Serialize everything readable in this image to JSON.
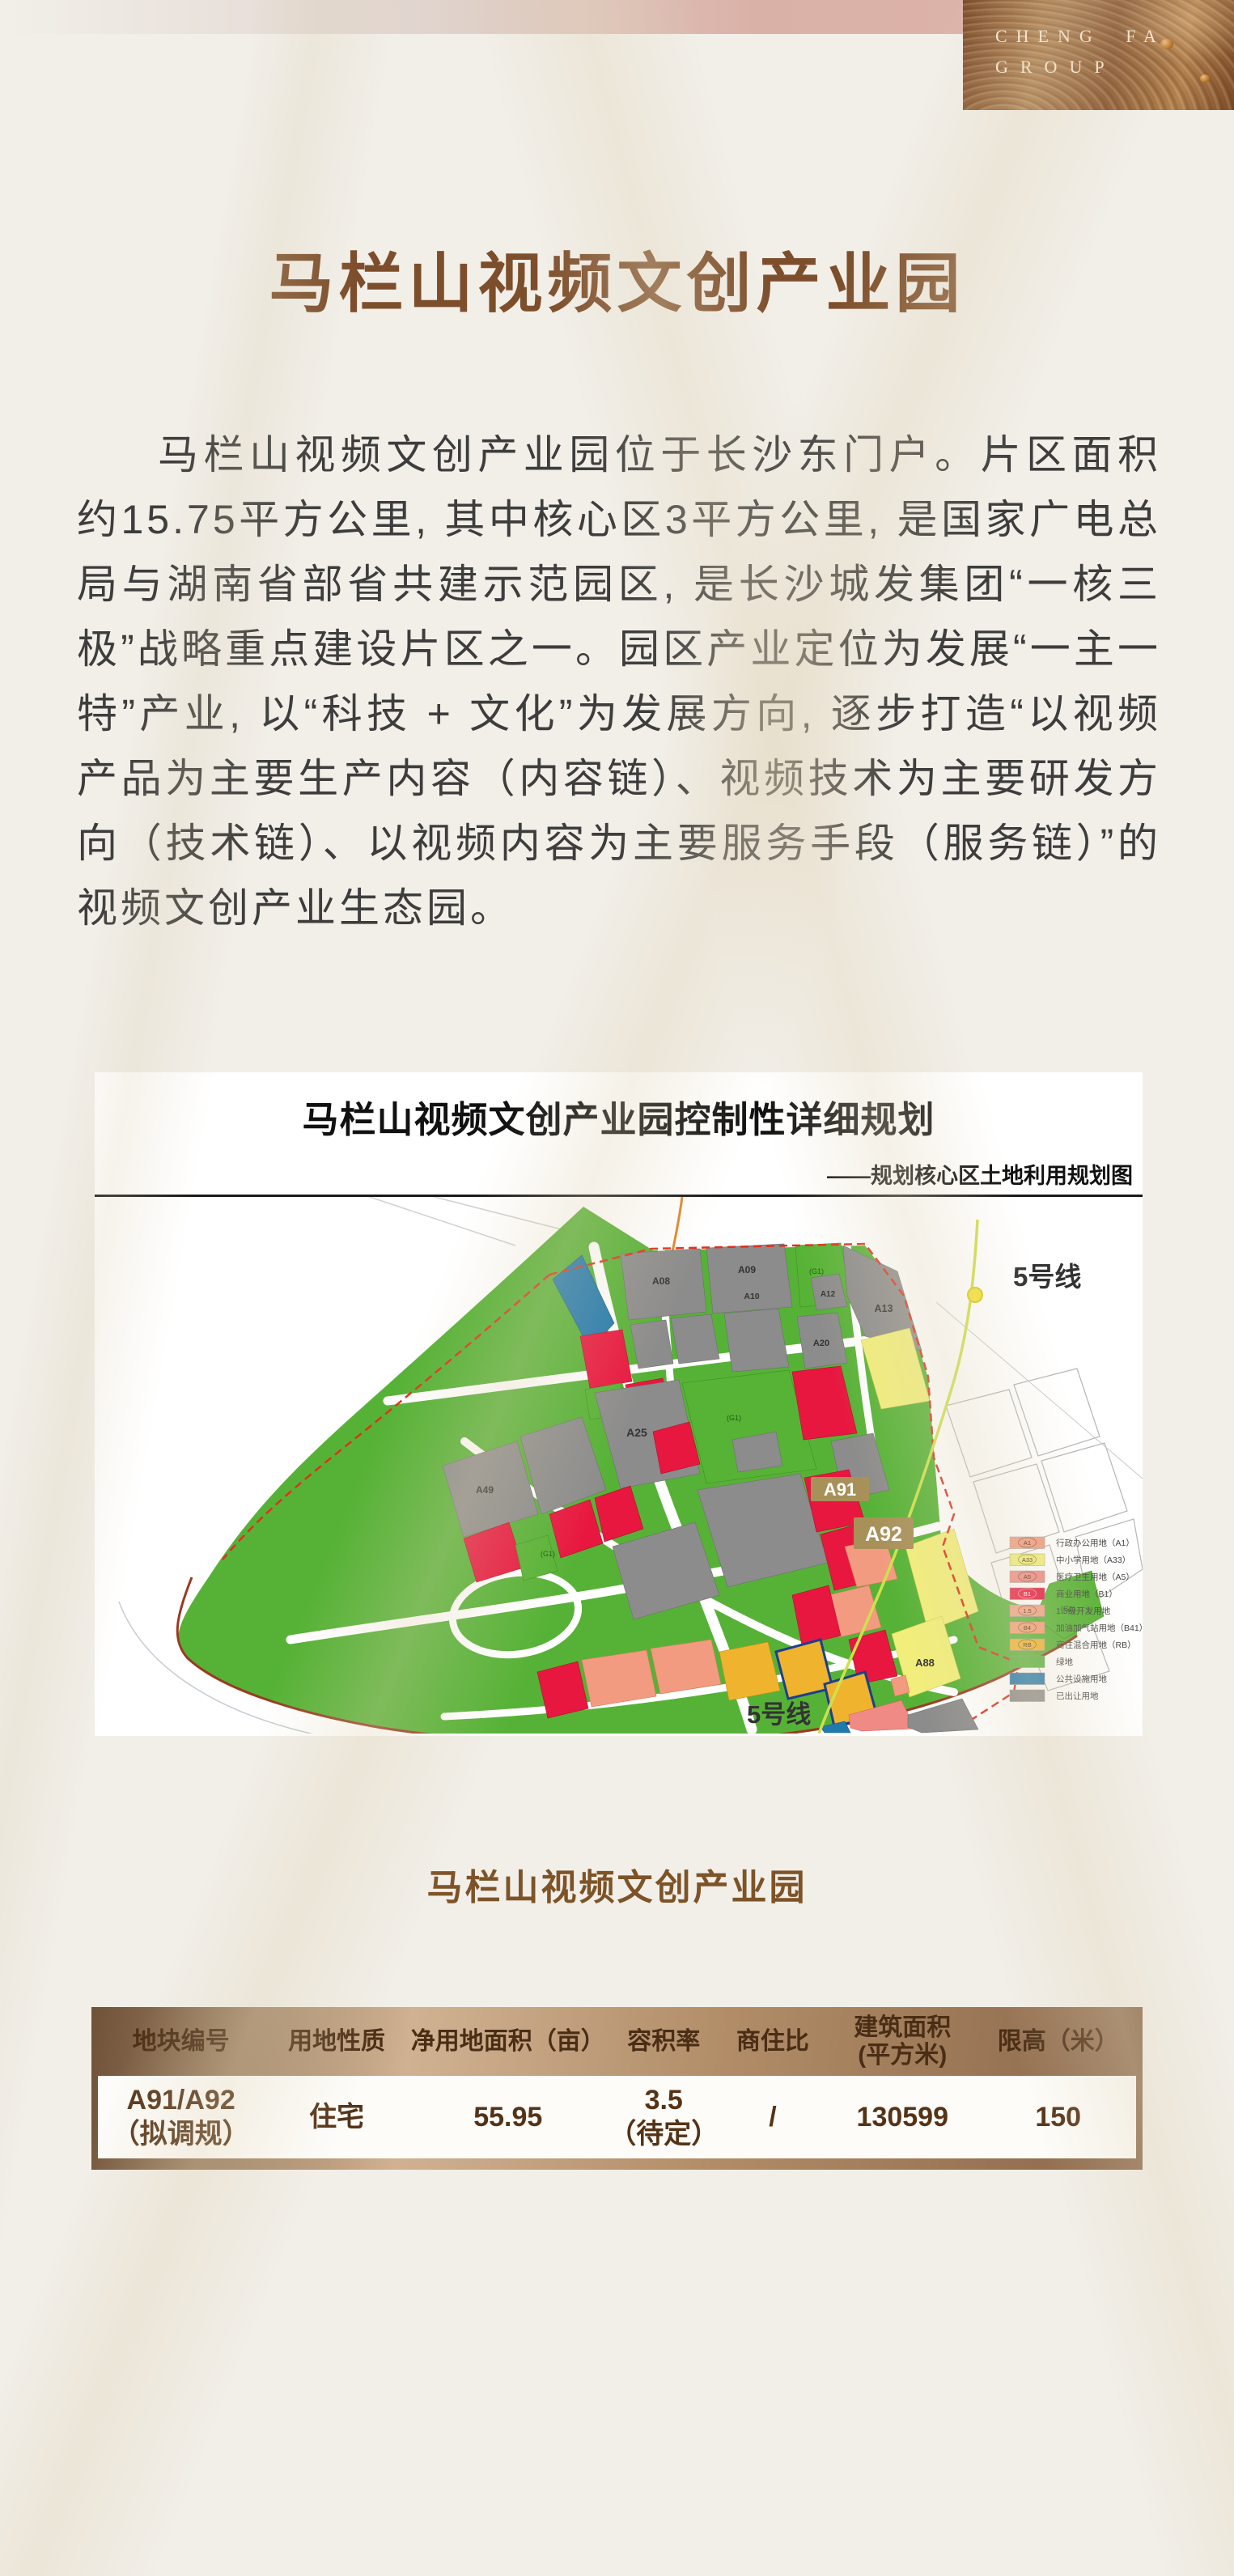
{
  "brand": {
    "line1": "CHENG FA",
    "line2": "GROUP"
  },
  "hero": {
    "title": "马栏山视频文创产业园"
  },
  "intro": {
    "paragraph": "马栏山视频文创产业园位于长沙东门户。片区面积约15.75平方公里, 其中核心区3平方公里, 是国家广电总局与湖南省部省共建示范园区, 是长沙城发集团“一核三极”战略重点建设片区之一。园区产业定位为发展“一主一特”产业, 以“科技 + 文化”为发展方向, 逐步打造“以视频产品为主要生产内容（内容链）、视频技术为主要研发方向（技术链）、以视频内容为主要服务手段（服务链）”的视频文创产业生态园。"
  },
  "map": {
    "title": "马栏山视频文创产业园控制性详细规划",
    "subtitle": "——规划核心区土地利用规划图",
    "metro_label_top": "5号线",
    "metro_label_bottom": "5号线",
    "plot_a91": "A91",
    "plot_a92": "A92",
    "block_labels": {
      "a08": "A08",
      "a09": "A09",
      "a10": "A10",
      "a12": "A12",
      "a13": "A13",
      "a20": "A20",
      "a25": "A25",
      "a49": "A49",
      "a88": "A88",
      "g1": "(G1)"
    },
    "legend": [
      {
        "code": "A1",
        "color": "#f29b80",
        "label": "行政办公用地（A1）"
      },
      {
        "code": "A33",
        "color": "#f1ef79",
        "label": "中小学用地（A33）"
      },
      {
        "code": "A5",
        "color": "#f08a84",
        "label": "医疗卫生用地（A5）"
      },
      {
        "code": "B1",
        "color": "#e8173f",
        "label": "商业用地（B1）"
      },
      {
        "code": "1.5",
        "color": "#f2a184",
        "label": "1.5级开发用地"
      },
      {
        "code": "B4",
        "color": "#f49f72",
        "label": "加油加气站用地（B41）"
      },
      {
        "code": "RB",
        "color": "#f0b32e",
        "label": "商住混合用地（RB）"
      },
      {
        "code": "",
        "color": "#57b33a",
        "label": "绿地"
      },
      {
        "code": "",
        "color": "#2279ae",
        "label": "公共设施用地"
      },
      {
        "code": "",
        "color": "#8c8c8c",
        "label": "已出让用地"
      }
    ]
  },
  "section": {
    "title": "马栏山视频文创产业园"
  },
  "table": {
    "headers": [
      "地块编号",
      "用地性质",
      "净用地面积（亩）",
      "容积率",
      "商住比",
      "建筑面积\n(平方米)",
      "限高（米）"
    ],
    "row": [
      "A91/A92\n（拟调规）",
      "住宅",
      "55.95",
      "3.5\n（待定）",
      "/",
      "130599",
      "150"
    ]
  }
}
